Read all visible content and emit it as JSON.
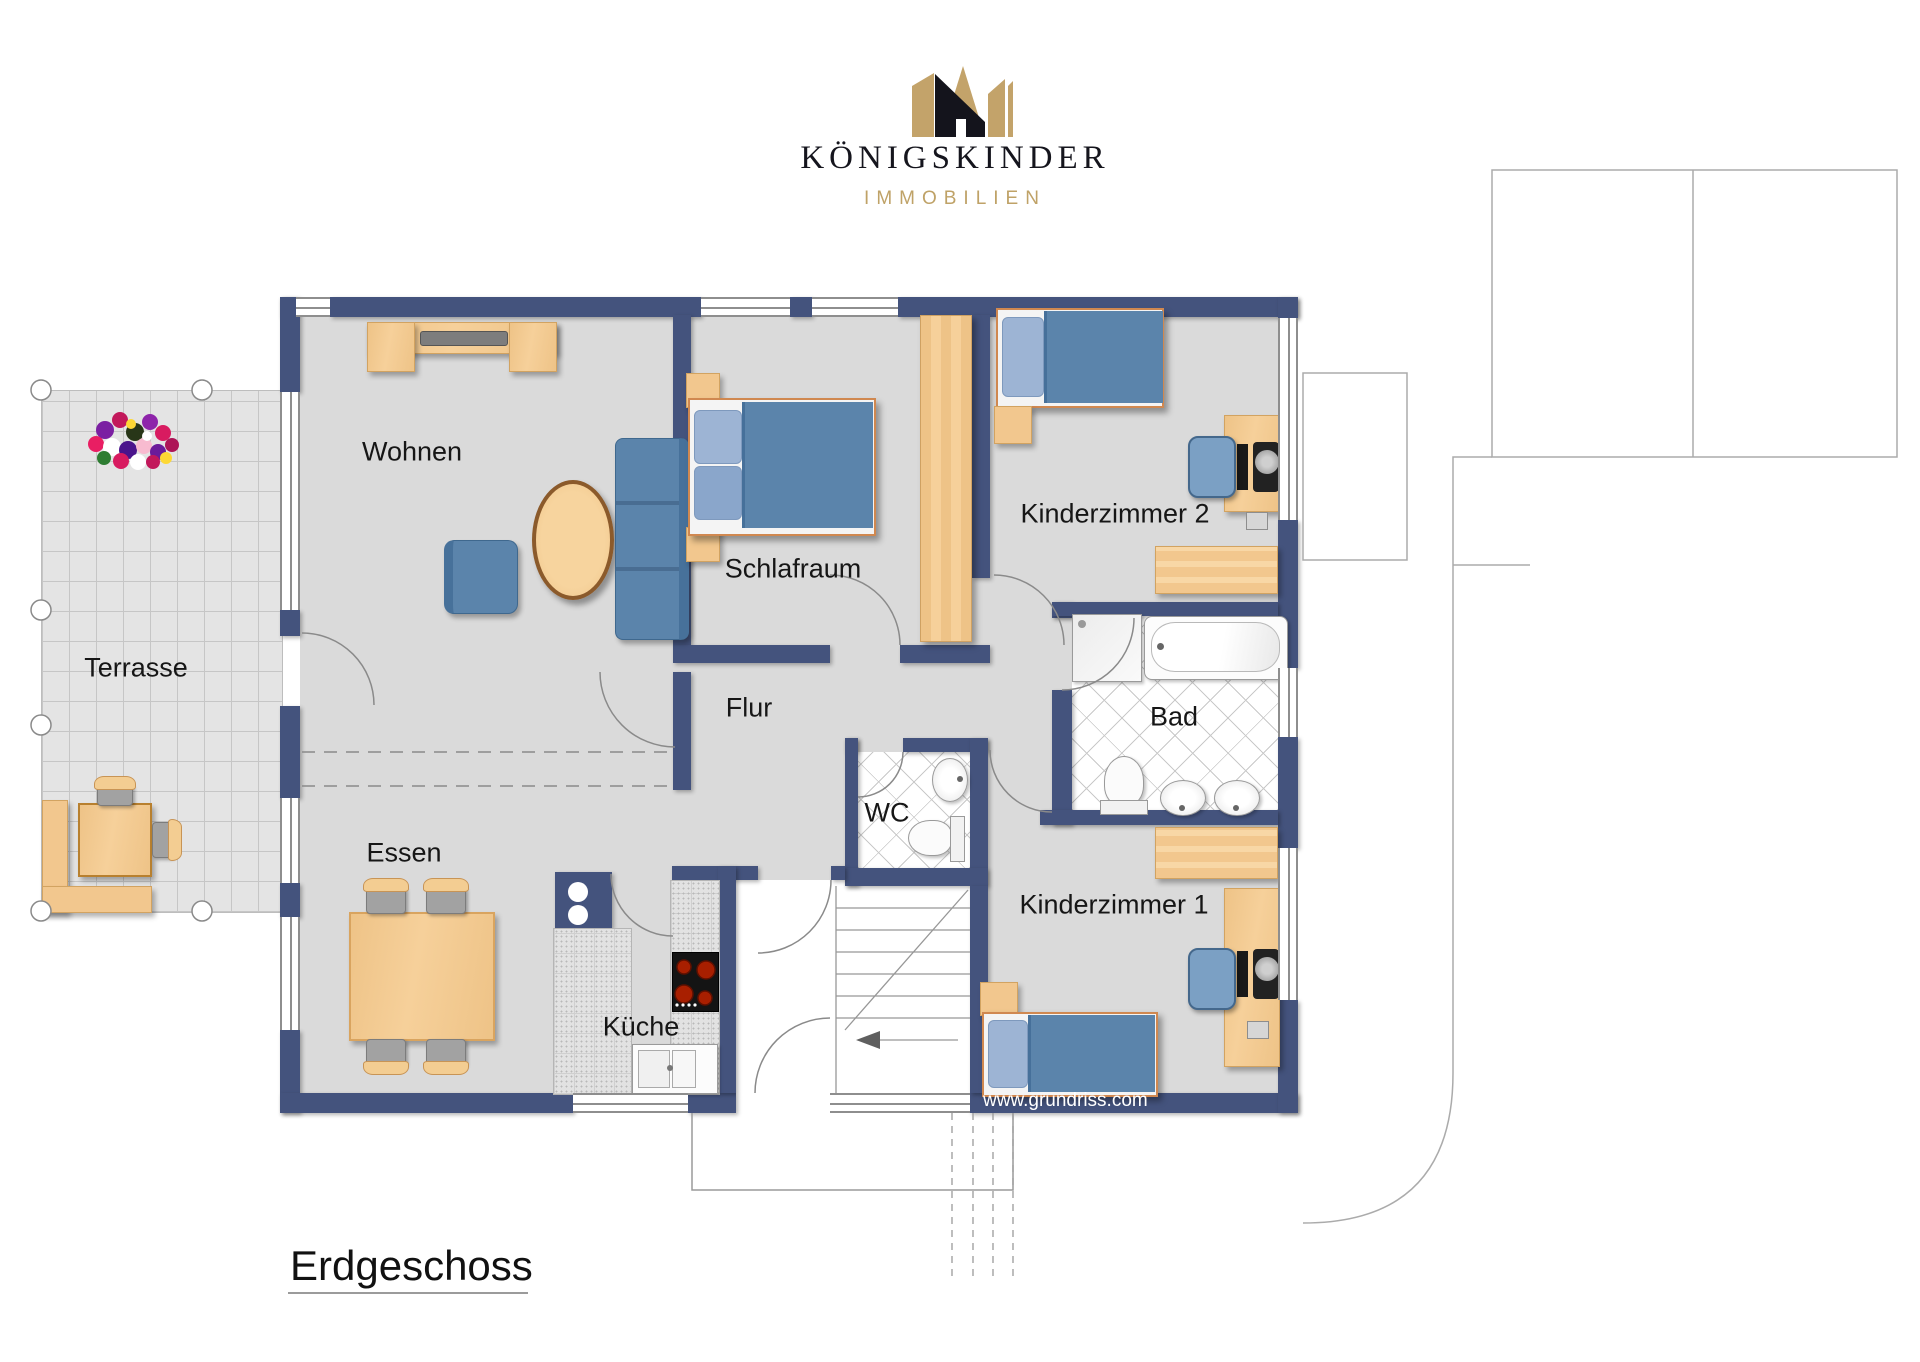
{
  "logo": {
    "brand": "KÖNIGSKINDER",
    "subtitle": "IMMOBILIEN",
    "crown_icon": "crown-house-icon"
  },
  "plan": {
    "floor_label": "Erdgeschoss",
    "watermark": "www.grundriss.com",
    "rooms": {
      "wohnen": {
        "label": "Wohnen"
      },
      "schlafraum": {
        "label": "Schlafraum"
      },
      "kinderzimmer2": {
        "label": "Kinderzimmer 2"
      },
      "terrasse": {
        "label": "Terrasse"
      },
      "flur": {
        "label": "Flur"
      },
      "bad": {
        "label": "Bad"
      },
      "wc": {
        "label": "WC"
      },
      "essen": {
        "label": "Essen"
      },
      "kueche": {
        "label": "Küche"
      },
      "kinderzimmer1": {
        "label": "Kinderzimmer 1"
      }
    }
  },
  "colors": {
    "wall": "#44537d",
    "floor": "#dadada",
    "terrace": "#e4e4e4",
    "wood": "#f2c78e",
    "furniture_blue": "#5b84ab",
    "bed_frame_orange": "#d08850",
    "logo_gold": "#c3a36a",
    "logo_black": "#14141c",
    "outline_gray": "#8a8a8a"
  }
}
